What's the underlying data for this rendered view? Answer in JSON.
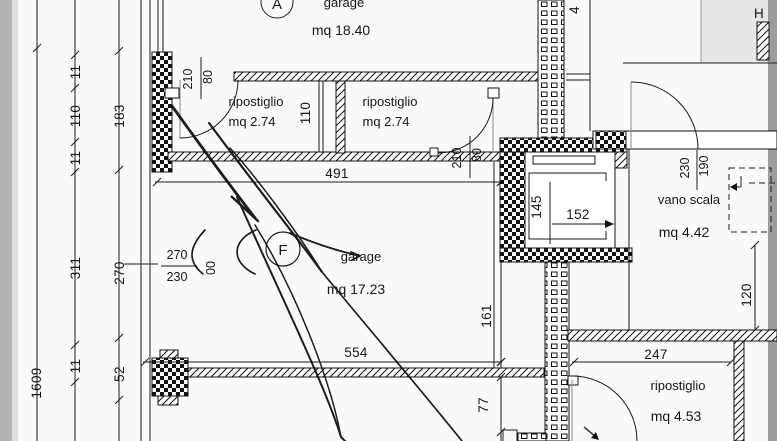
{
  "document": {
    "kind": "scanned architectural floor plan (basement garages / storage level)",
    "colors": {
      "paper": "#fafaf8",
      "ink": "#1c1c1c",
      "scan_edge": "#9c9c9a",
      "scan_corner": "#e6e6e4"
    }
  },
  "rooms": {
    "garage_a": {
      "tag": "A",
      "name": "garage",
      "area": "mq 18.40"
    },
    "rip1": {
      "name": "ripostiglio",
      "area": "mq 2.74"
    },
    "rip2": {
      "name": "ripostiglio",
      "area": "mq 2.74"
    },
    "garage_f": {
      "tag": "F",
      "name": "garage",
      "area": "mq 17.23"
    },
    "vano_scala": {
      "name": "vano scala",
      "area": "mq 4.42"
    },
    "rip3": {
      "name": "ripostiglio",
      "area": "mq 4.53"
    }
  },
  "dimensions": {
    "left_total": "1609",
    "left_11_top": "11",
    "left_110": "110",
    "left_11_mid": "11",
    "left_183": "183",
    "left_311": "311",
    "left_270": "270",
    "left_11_bot": "11",
    "left_52": "52",
    "door1_210": "210",
    "door1_80": "80",
    "rip1_110": "110",
    "door2_210": "210",
    "door2_80": "80",
    "garage_f_491": "491",
    "note_270": "270",
    "note_230": "230",
    "note_00": "00",
    "garage_f_554": "554",
    "garage_f_161": "161",
    "below_77": "77",
    "lift_145": "145",
    "lift_152": "152",
    "scala_230": "230",
    "scala_190": "190",
    "right_120": "120",
    "rip3_247": "247",
    "partial_top": "4"
  },
  "annotations": {
    "corner_label": "H"
  }
}
